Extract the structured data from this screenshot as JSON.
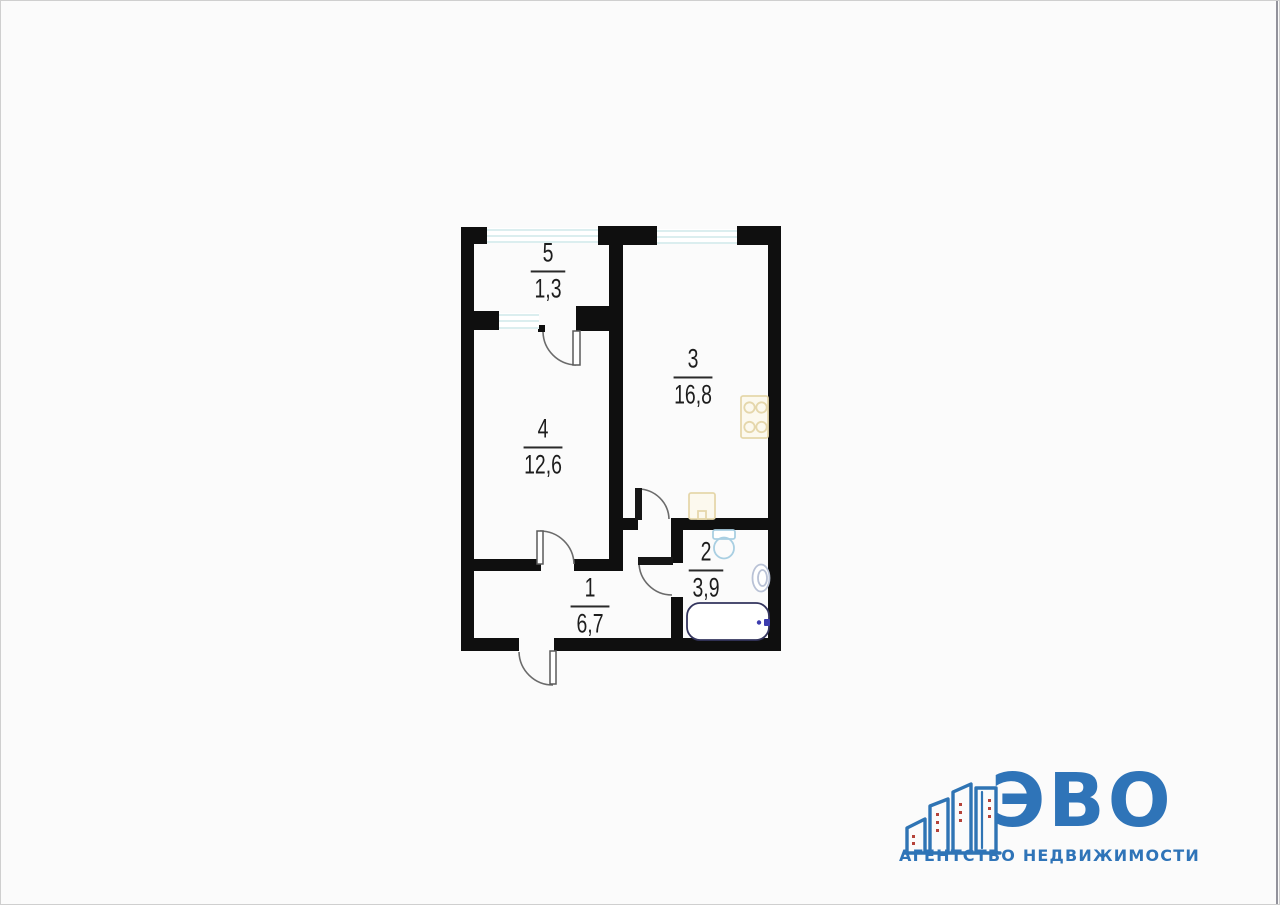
{
  "page": {
    "background": "#fbfbfb",
    "border_color": "#cfcfcf",
    "right_edge_line_color": "#92929b"
  },
  "floor_plan": {
    "wall_color": "#0f0f0f",
    "window_glass_color": "#cfe8ea",
    "door_arc_color": "#6b6b6b",
    "door_leaf_dark_color": "#161616",
    "rooms": {
      "hallway": {
        "number": "1",
        "area": "6,7"
      },
      "bathroom": {
        "number": "2",
        "area": "3,9"
      },
      "kitchen": {
        "number": "3",
        "area": "16,8"
      },
      "living": {
        "number": "4",
        "area": "12,6"
      },
      "balcony": {
        "number": "5",
        "area": "1,3"
      }
    },
    "fixtures": {
      "stove": "stove-icon",
      "kitchen_sink": "sink-icon",
      "toilet": "toilet-icon",
      "washbasin": "washbasin-icon",
      "bathtub": "bathtub-icon"
    },
    "fixture_colors": {
      "kitchen_fixture_stroke": "#e5d7ab",
      "kitchen_fixture_fill": "#fcf9ee",
      "bath_fixture_stroke": "#a9cfe2",
      "bathtub_outline": "#34355e",
      "faucet": "#3c3cae"
    }
  },
  "logo": {
    "brand": "ЭВО",
    "tagline": "АГЕНТСТВО НЕДВИЖИМОСТИ",
    "brand_color": "#2f74b8",
    "building_outline_color": "#2f74b4",
    "window_dot_color": "#b5433a"
  }
}
